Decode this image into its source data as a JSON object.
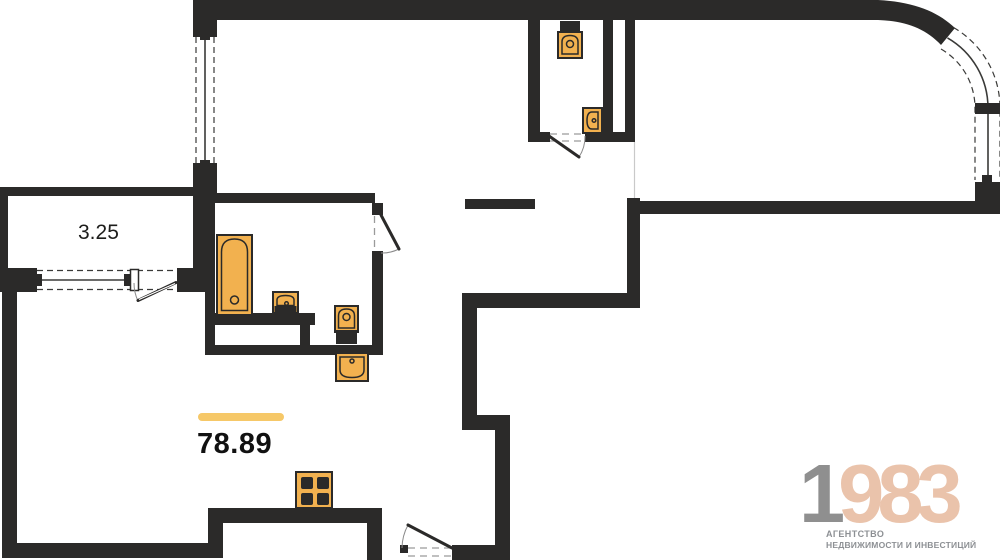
{
  "floor_plan": {
    "areas": {
      "balcony": "3.25",
      "total": "78.89"
    },
    "fixtures": [
      "toilet-icon",
      "wall-sink-icon",
      "bathtub-icon",
      "bathroom-sink-icon",
      "washbasin-icon",
      "stove-icon"
    ],
    "features": [
      "curved-corner-window",
      "balcony-window-with-door",
      "side-window",
      "entry-door",
      "bathroom-door",
      "wc-door"
    ]
  },
  "logo": {
    "prefix": "1",
    "suffix": "983",
    "tagline1": "АГЕНТСТВО",
    "tagline2": "НЕДВИЖИМОСТИ И ИНВЕСТИЦИЙ"
  },
  "colors": {
    "wall": "#2b2a29",
    "fixture": "#f2b14f",
    "accent": "#f6c868",
    "logo-gray": "#8f8f8f",
    "logo-salmon": "#eac3ab",
    "logo-text": "#8d9094",
    "winline": "#3a3a38",
    "bg": "#ffffff"
  }
}
